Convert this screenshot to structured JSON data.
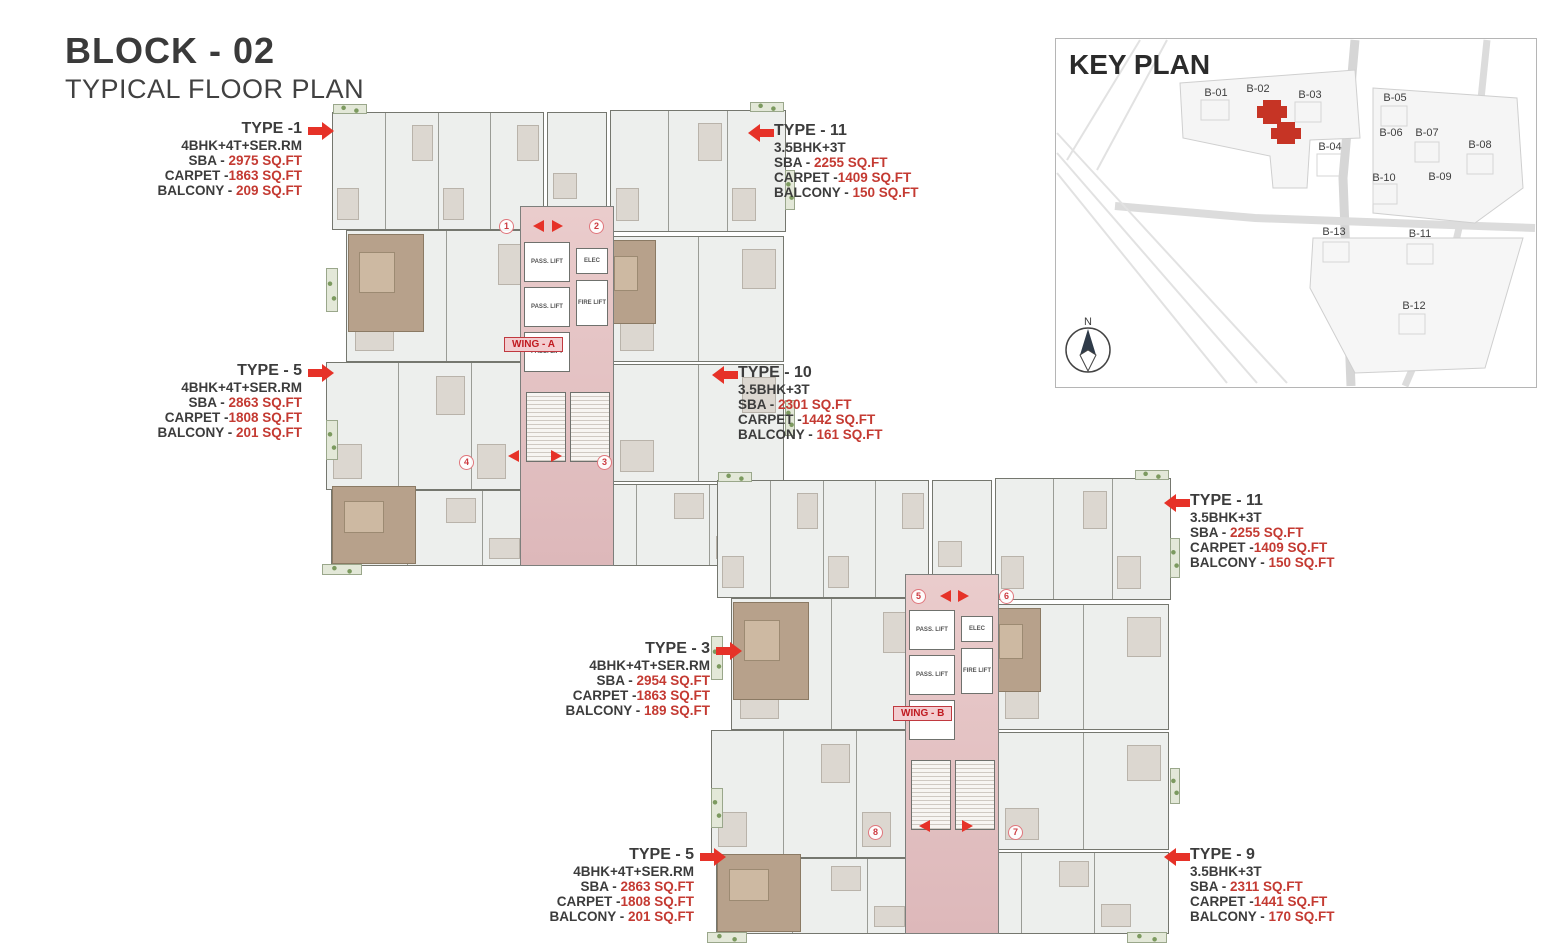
{
  "page": {
    "title": "BLOCK - 02",
    "subtitle": "TYPICAL FLOOR PLAN"
  },
  "key_plan": {
    "title": "KEY PLAN",
    "north_label": "N",
    "highlighted_block": "B-02",
    "blocks": [
      {
        "label": "B-01"
      },
      {
        "label": "B-02"
      },
      {
        "label": "B-03"
      },
      {
        "label": "B-04"
      },
      {
        "label": "B-05"
      },
      {
        "label": "B-06"
      },
      {
        "label": "B-07"
      },
      {
        "label": "B-08"
      },
      {
        "label": "B-09"
      },
      {
        "label": "B-10"
      },
      {
        "label": "B-11"
      },
      {
        "label": "B-12"
      },
      {
        "label": "B-13"
      }
    ]
  },
  "wings": [
    {
      "label": "WING - A",
      "entrance_numbers": [
        "1",
        "2",
        "3",
        "4"
      ]
    },
    {
      "label": "WING - B",
      "entrance_numbers": [
        "5",
        "6",
        "7",
        "8"
      ]
    }
  ],
  "core_labels": {
    "pass_lift": "PASS. LIFT",
    "fire_lift": "FIRE LIFT",
    "elec": "ELEC"
  },
  "unit_types": [
    {
      "name": "TYPE -1",
      "config": "4BHK+4T+SER.RM",
      "rows": [
        {
          "label": "SBA - ",
          "value": "2975 SQ.FT"
        },
        {
          "label": "CARPET -",
          "value": "1863 SQ.FT"
        },
        {
          "label": "BALCONY - ",
          "value": "209 SQ.FT"
        }
      ]
    },
    {
      "name": "TYPE - 11",
      "config": "3.5BHK+3T",
      "rows": [
        {
          "label": "SBA - ",
          "value": "2255 SQ.FT"
        },
        {
          "label": "CARPET -",
          "value": "1409 SQ.FT"
        },
        {
          "label": "BALCONY - ",
          "value": "150 SQ.FT"
        }
      ]
    },
    {
      "name": "TYPE - 5",
      "config": "4BHK+4T+SER.RM",
      "rows": [
        {
          "label": "SBA - ",
          "value": "2863 SQ.FT"
        },
        {
          "label": "CARPET -",
          "value": "1808 SQ.FT"
        },
        {
          "label": "BALCONY - ",
          "value": "201 SQ.FT"
        }
      ]
    },
    {
      "name": "TYPE - 10",
      "config": "3.5BHK+3T",
      "rows": [
        {
          "label": "SBA - ",
          "value": "2301 SQ.FT"
        },
        {
          "label": "CARPET -",
          "value": "1442 SQ.FT"
        },
        {
          "label": "BALCONY - ",
          "value": "161 SQ.FT"
        }
      ]
    },
    {
      "name": "TYPE - 11",
      "config": "3.5BHK+3T",
      "rows": [
        {
          "label": "SBA - ",
          "value": "2255 SQ.FT"
        },
        {
          "label": "CARPET -",
          "value": "1409 SQ.FT"
        },
        {
          "label": "BALCONY - ",
          "value": "150 SQ.FT"
        }
      ]
    },
    {
      "name": "TYPE - 3",
      "config": "4BHK+4T+SER.RM",
      "rows": [
        {
          "label": "SBA - ",
          "value": "2954 SQ.FT"
        },
        {
          "label": "CARPET -",
          "value": "1863 SQ.FT"
        },
        {
          "label": "BALCONY - ",
          "value": "189 SQ.FT"
        }
      ]
    },
    {
      "name": "TYPE - 5",
      "config": "4BHK+4T+SER.RM",
      "rows": [
        {
          "label": "SBA - ",
          "value": "2863 SQ.FT"
        },
        {
          "label": "CARPET -",
          "value": "1808 SQ.FT"
        },
        {
          "label": "BALCONY - ",
          "value": "201 SQ.FT"
        }
      ]
    },
    {
      "name": "TYPE - 9",
      "config": "3.5BHK+3T",
      "rows": [
        {
          "label": "SBA - ",
          "value": "2311 SQ.FT"
        },
        {
          "label": "CARPET -",
          "value": "1441 SQ.FT"
        },
        {
          "label": "BALCONY - ",
          "value": "170 SQ.FT"
        }
      ]
    }
  ],
  "colors": {
    "accent_red": "#e63228",
    "value_red": "#c43a32",
    "corridor_pink": "#e6c4c5",
    "tan_room": "#b7a18b",
    "balcony_green": "#7c9a5f",
    "highlight_red": "#c63425"
  }
}
